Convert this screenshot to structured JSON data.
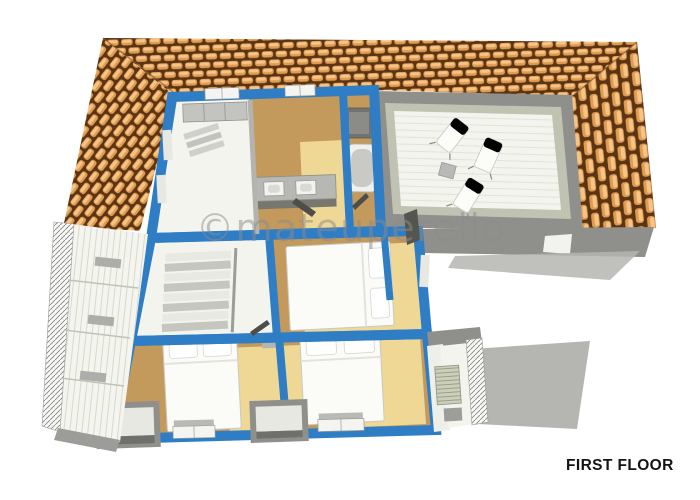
{
  "watermark": {
    "text": "©mateuperello"
  },
  "floor_label": {
    "text": "FIRST FLOOR"
  },
  "colors": {
    "background": "#ffffff",
    "wall_blue": "#2f7dc5",
    "roof_tile_light": "#f6c488",
    "roof_tile_mid": "#df9b50",
    "roof_gap_dark": "#5a3413",
    "roof_hip": "#8a5526",
    "floor_tan": "#c49a5c",
    "floor_tan_light": "#efd795",
    "floor_white": "#f5f5ef",
    "room_white": "#f4f4ee",
    "wall_gray": "#8f8f8c",
    "parapet_inner": "#c0c3b2",
    "furniture_gray": "#b7b7b3",
    "furniture_dark": "#72726f",
    "shadow_gray": "#b5b5b2",
    "watermark_gray": "#8c8c8c",
    "label_black": "#141414"
  }
}
